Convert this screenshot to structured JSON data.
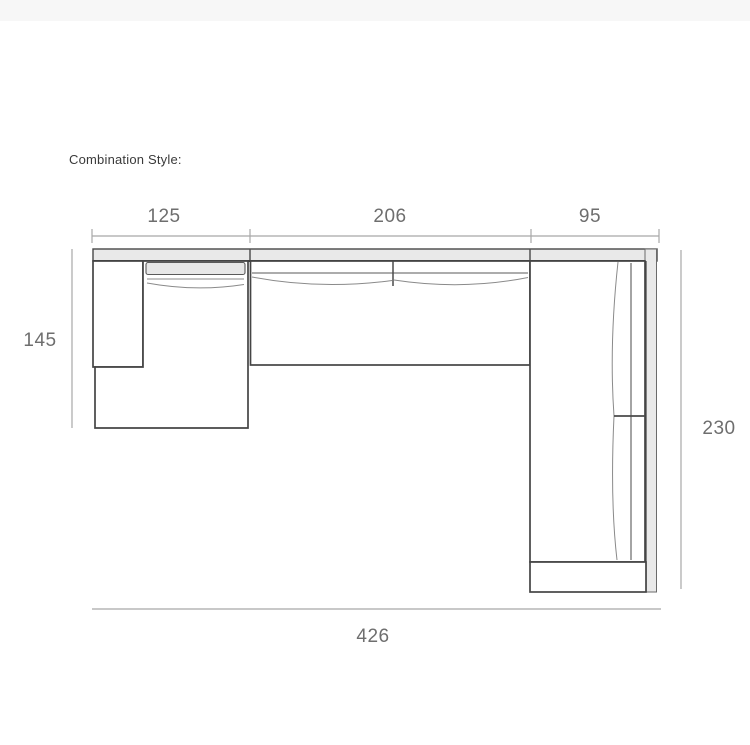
{
  "header": {
    "label": "Combination Style:"
  },
  "diagram": {
    "type": "dimensioned-technical-drawing",
    "subject": "L-shaped sectional sofa combination, top view",
    "units_shown": false,
    "dimensions": {
      "top_segments": [
        "125",
        "206",
        "95"
      ],
      "left_depth": "145",
      "right_depth": "230",
      "total_width": "426"
    },
    "parts": [
      "left-armrest",
      "chaise-section",
      "middle-seat-section",
      "right-seat-section",
      "back-rail",
      "right-back-panel",
      "bottom-armrest"
    ]
  },
  "colors": {
    "page_background": "#ffffff",
    "top_bar": "#f7f7f7",
    "sofa_outline": "#454545",
    "sofa_fill": "#ffffff",
    "rail_fill": "#e9e9e9",
    "cushion_detail_line": "#8a8a8a",
    "dimension_line": "#a8a8a8",
    "dimension_text": "#6e6e6e",
    "heading_text": "#3a3a3a"
  }
}
